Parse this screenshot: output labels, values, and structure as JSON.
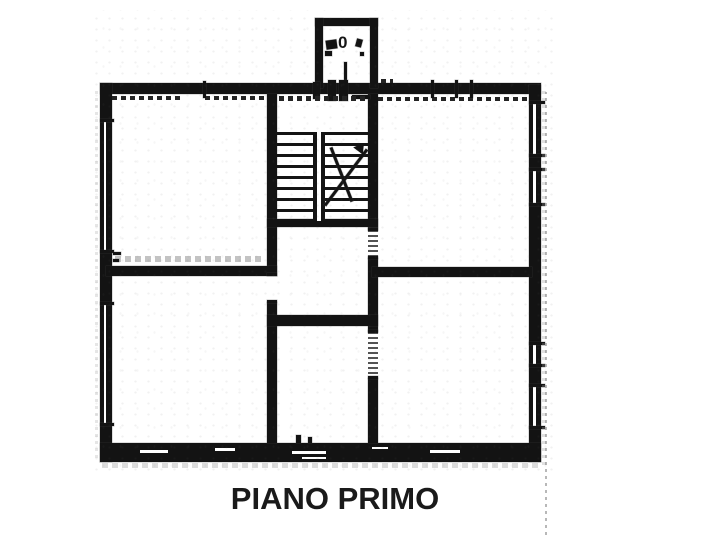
{
  "title": "PIANO PRIMO",
  "balcony": {
    "label": "0"
  },
  "colors": {
    "ink": "#131313",
    "paper": "#ffffff",
    "scan_noise": "#9a9a9a"
  },
  "icons": {
    "stair_direction_arrow": "diagonal-arrow-line"
  }
}
